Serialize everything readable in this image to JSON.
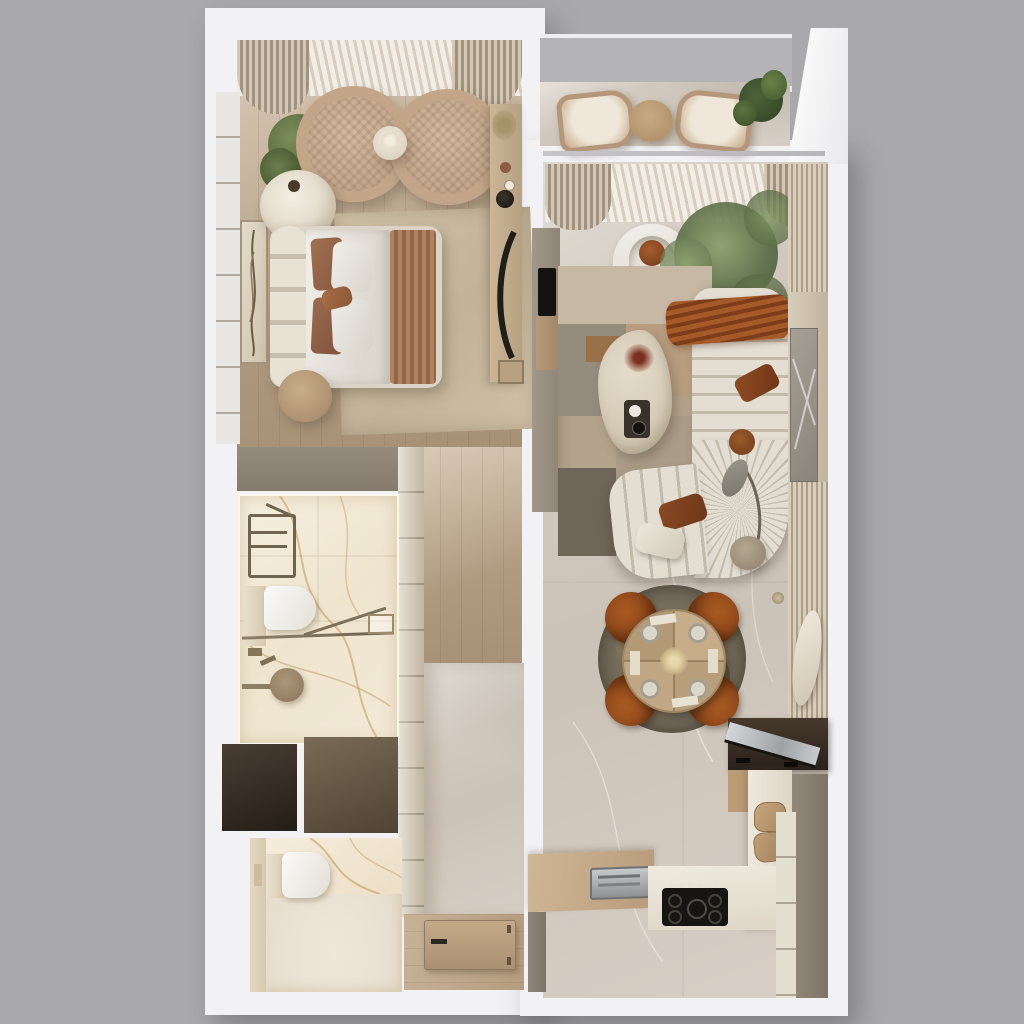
{
  "meta": {
    "scene": "3d-apartment-floor-plan-top-view",
    "style": "photoreal warm neutral render, no text labels visible"
  },
  "palette": {
    "bg": "#a9a9ab",
    "wall": "#f2f1f3",
    "wall_shadow": "#d9d8db",
    "taupe": "#8d8477",
    "shaft_dark": "#352c24",
    "shaft_brown": "#6e5f4d",
    "wood": "#ccb79c",
    "wood_dark": "#b29c80",
    "marble": "#d8d0c6",
    "marble_bath": "#f3ebda",
    "gold_vein": "#c29c57",
    "cream": "#e3ddd2",
    "cream_shadow": "#c2bbac",
    "rust": "#9a5126",
    "rust_dark": "#7c3e1d",
    "leather": "#a1551f",
    "green": "#5f7048",
    "green_light": "#8fa06f",
    "black": "#1d1b18",
    "glass": "#b4b4b6",
    "metal": "#8b8070",
    "rug_beige": "#b3a28c",
    "rug_dark": "#6f665a"
  },
  "rooms": [
    {
      "id": "bedroom",
      "furniture": [
        "sheer-curtains",
        "rattan-lounge-chair",
        "rattan-lounge-chair",
        "round-side-table",
        "potted-plant",
        "pouf",
        "double-bed",
        "bedside-table",
        "area-rug",
        "wall-art",
        "vanity-desk",
        "built-in-closet"
      ]
    },
    {
      "id": "balcony",
      "furniture": [
        "glass-railing",
        "lounge-chair",
        "lounge-chair",
        "round-table",
        "potted-plant"
      ]
    },
    {
      "id": "living-room",
      "furniture": [
        "sheer-curtains",
        "tv",
        "media-panel",
        "curved-armchair",
        "olive-tree",
        "channel-tufted-sofa",
        "throw-blanket",
        "cushions",
        "arc-floor-lamp",
        "travertine-coffee-table",
        "patchwork-rug",
        "wall-unit",
        "sculpture"
      ]
    },
    {
      "id": "dining-area",
      "furniture": [
        "round-rug",
        "round-dining-table",
        "dining-chair",
        "dining-chair",
        "dining-chair",
        "dining-chair",
        "place-settings",
        "flower-centerpiece",
        "wall-light"
      ]
    },
    {
      "id": "kitchen",
      "furniture": [
        "bar-console",
        "mirror-shelf",
        "wine-niche",
        "tall-cabinets",
        "countertop-wood",
        "sink",
        "countertop-stone",
        "gas-cooktop",
        "cutting-boards"
      ]
    },
    {
      "id": "bathroom",
      "furniture": [
        "towel-ladder",
        "wall-hung-toilet",
        "glass-shower-partition",
        "shower-head",
        "shower-arm"
      ]
    },
    {
      "id": "wc",
      "furniture": [
        "wall-hung-toilet",
        "flush-plate"
      ]
    },
    {
      "id": "hallway",
      "furniture": [
        "built-in-wardrobe",
        "entry-door",
        "door-handle"
      ]
    },
    {
      "id": "service",
      "furniture": [
        "duct-shaft",
        "duct-shaft"
      ]
    }
  ]
}
